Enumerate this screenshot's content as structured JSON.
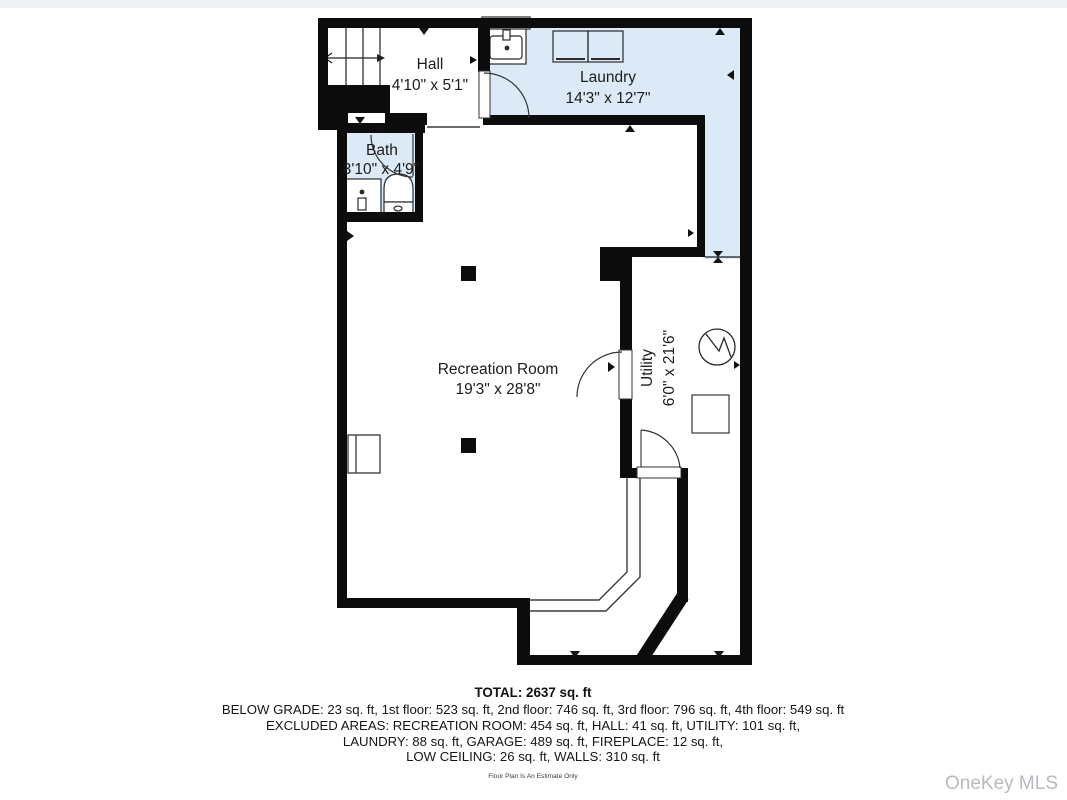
{
  "floor_plan": {
    "rooms": [
      {
        "name": "Hall",
        "dims": "4'10\" x 5'1\""
      },
      {
        "name": "Laundry",
        "dims": "14'3\" x 12'7\""
      },
      {
        "name": "Bath",
        "dims": "3'10\" x 4'9\""
      },
      {
        "name": "Recreation Room",
        "dims": "19'3\" x 28'8\""
      },
      {
        "name": "Utility",
        "dims": "6'0\" x 21'6\""
      }
    ],
    "summary": {
      "total": "TOTAL: 2637 sq. ft",
      "floors": "BELOW GRADE: 23 sq. ft, 1st floor: 523 sq. ft, 2nd floor: 746 sq. ft, 3rd floor: 796 sq. ft, 4th floor: 549 sq. ft",
      "excluded1": "EXCLUDED AREAS: RECREATION ROOM: 454 sq. ft, HALL: 41 sq. ft, UTILITY: 101 sq. ft,",
      "excluded2": "LAUNDRY: 88 sq. ft, GARAGE: 489 sq. ft, FIREPLACE: 12 sq. ft,",
      "excluded3": "LOW CEILING: 26 sq. ft, WALLS: 310 sq. ft"
    },
    "disclaimer": "Floor Plan Is An Estimate Only",
    "watermark": "OneKey MLS",
    "colors": {
      "room_fill": "#dbeaf6",
      "wall": "#0c0c0c",
      "thin_line": "#3c3c3c",
      "watermark": "#b7bbbf"
    }
  }
}
